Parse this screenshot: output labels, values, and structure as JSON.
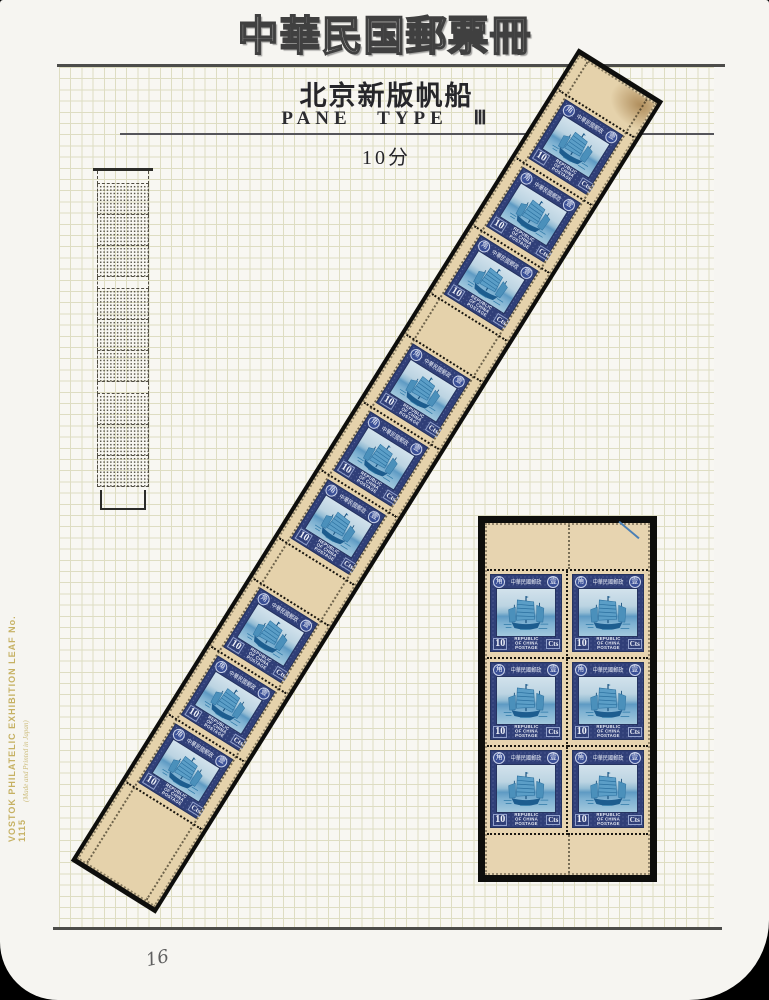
{
  "page": {
    "title": "中華民国郵票冊",
    "page_number": "16",
    "side_text": "VOSTOK PHILATELIC EXHIBITION LEAF No. 1115",
    "side_subtext": "(Made and Printed in Japan)"
  },
  "header": {
    "series_title": "北京新版帆船",
    "pane_type": "PANE TYPE Ⅲ",
    "denomination": "10分"
  },
  "stamp": {
    "value": "10",
    "unit": "Cts",
    "country_lines": [
      "REPUBLIC",
      "OF CHINA",
      "POSTAGE"
    ],
    "top_inscription": "中華民國郵政",
    "medallion_left": "角",
    "medallion_right": "壹",
    "frame_color": "#303f78",
    "vignette_color": "#5e9ac3",
    "paper_color": "#e5d2ab",
    "mount_color": "#0e0e0c",
    "grid_line_color": "#deddc2",
    "imprint_color": "#c6b163"
  },
  "strip": {
    "groups": 3,
    "stamps_per_group": 3,
    "total_stamps": 9
  },
  "block": {
    "rows": 3,
    "cols": 2,
    "total_stamps": 6
  }
}
